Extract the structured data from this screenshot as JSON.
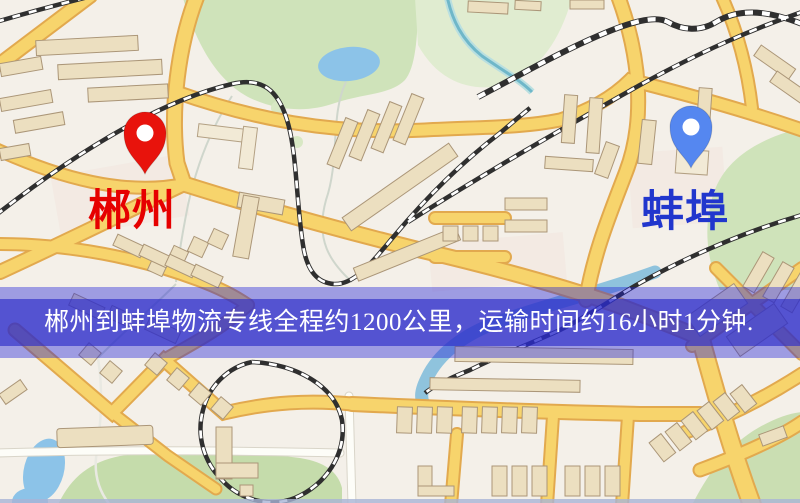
{
  "banner": {
    "text": "郴州到蚌埠物流专线全程约1200公里，运输时间约16小时1分钟.",
    "text_color": "#ffffff",
    "band_color_dark": "rgba(45,45,200,0.66)",
    "band_color_light": "rgba(30,30,215,0.40)"
  },
  "markers": {
    "origin": {
      "label": "郴州",
      "pin_color": "#e8130c",
      "pin_inner_color": "#ffffff",
      "label_color": "#e60000"
    },
    "destination": {
      "label": "蚌埠",
      "pin_color": "#5587f0",
      "pin_inner_color": "#ffffff",
      "label_color": "#2136cd"
    }
  },
  "map_palette": {
    "background": "#f4f0e9",
    "road_fill": "#f7d46c",
    "road_casing": "#e2a94e",
    "white_road": "#fdfdf8",
    "water": "#8cc3e8",
    "park_green": "#cfe3ba",
    "building": "#ecdfc0",
    "railway": "#2f2f2f"
  }
}
